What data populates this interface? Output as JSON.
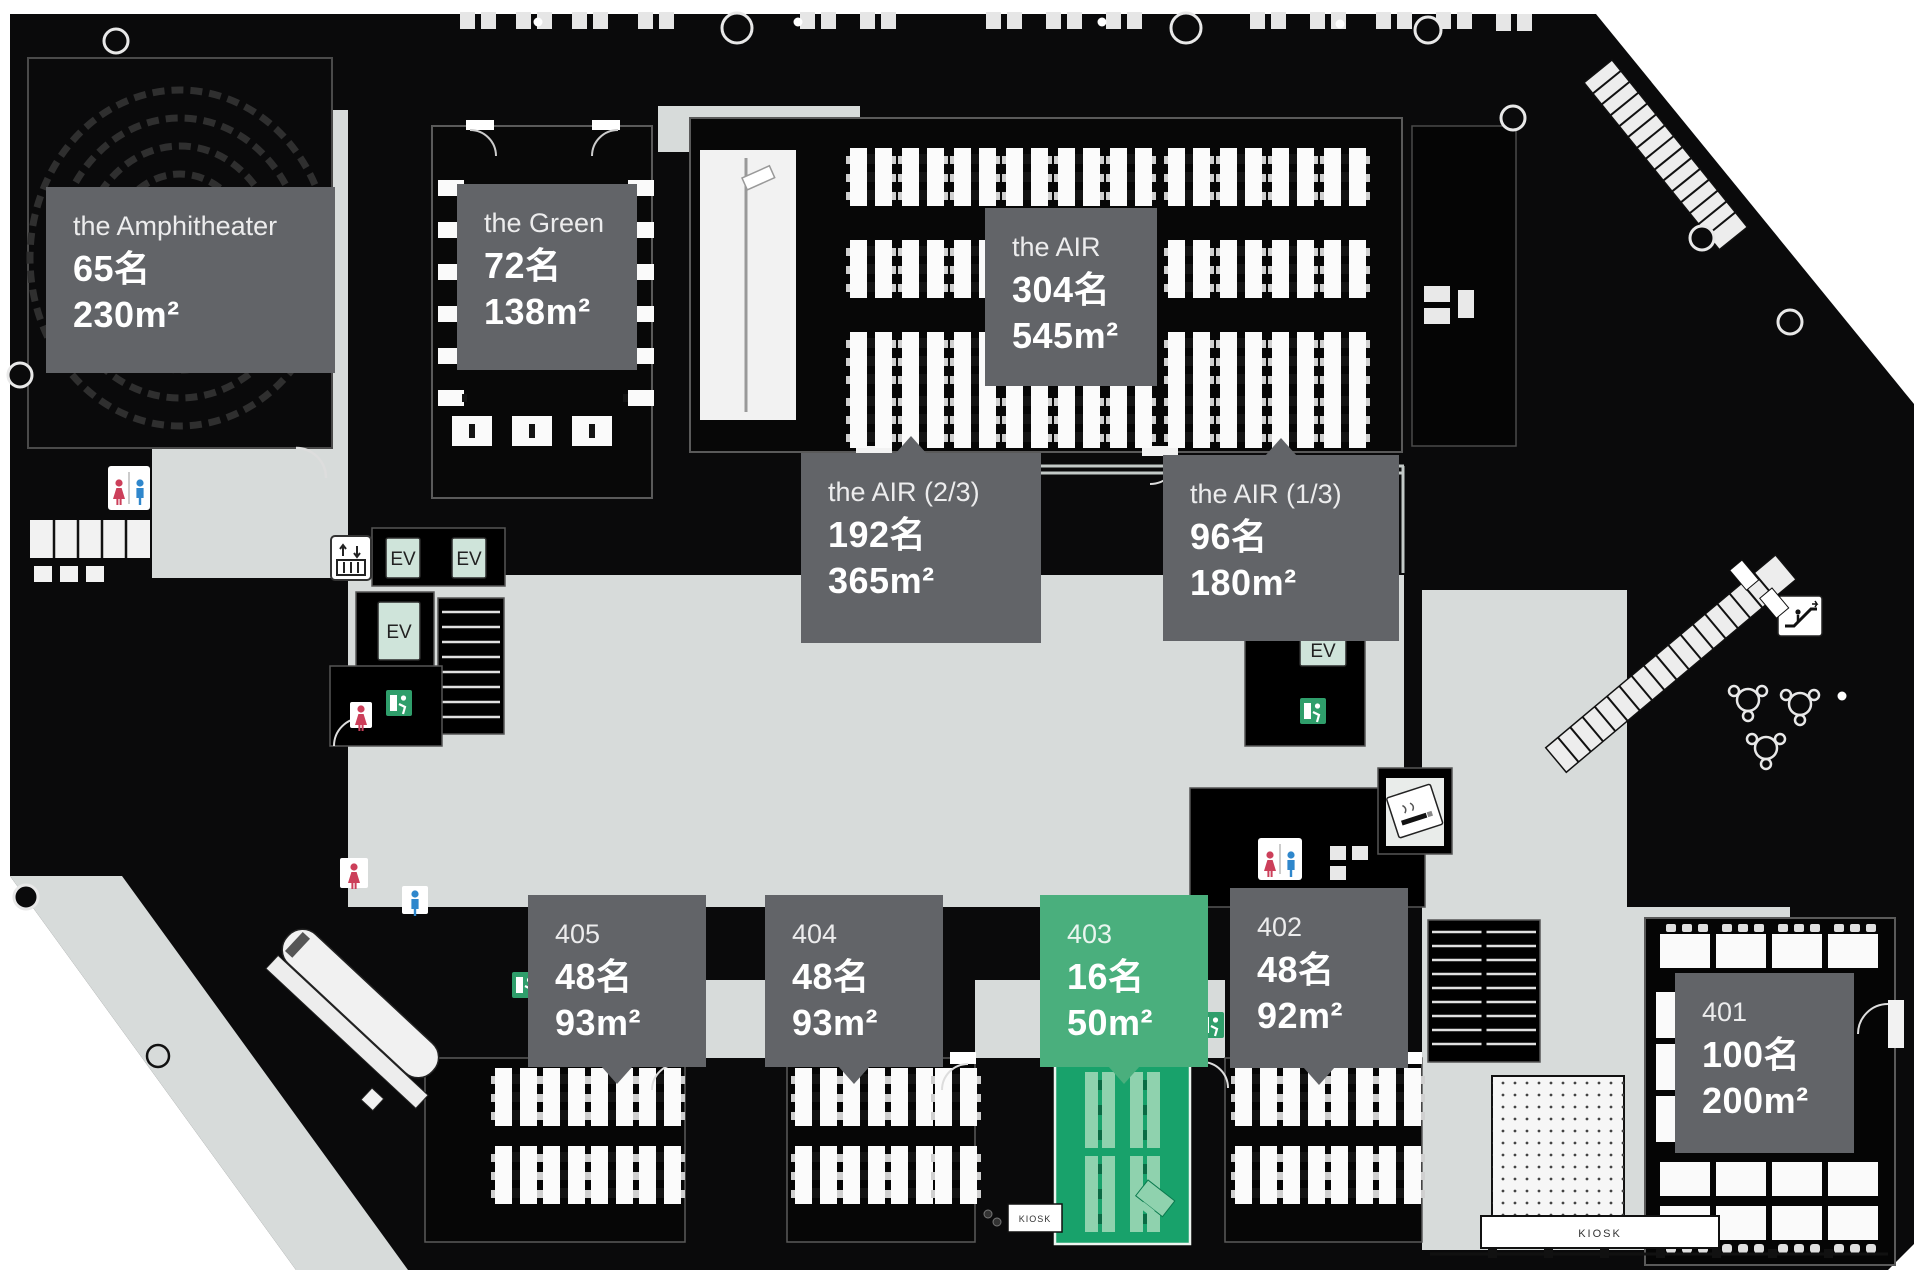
{
  "labels": [
    {
      "name": "the Amphitheater",
      "capacity": "65名",
      "area": "230m²"
    },
    {
      "name": "the Green",
      "capacity": "72名",
      "area": "138m²"
    },
    {
      "name": "the AIR",
      "capacity": "304名",
      "area": "545m²"
    },
    {
      "name": "the AIR (2/3)",
      "capacity": "192名",
      "area": "365m²"
    },
    {
      "name": "the AIR (1/3)",
      "capacity": "96名",
      "area": "180m²"
    },
    {
      "name": "405",
      "capacity": "48名",
      "area": "93m²"
    },
    {
      "name": "404",
      "capacity": "48名",
      "area": "93m²"
    },
    {
      "name": "403",
      "capacity": "16名",
      "area": "50m²",
      "highlighted": true
    },
    {
      "name": "402",
      "capacity": "48名",
      "area": "92m²"
    },
    {
      "name": "401",
      "capacity": "100名",
      "area": "200m²"
    }
  ],
  "signs": {
    "ev": "EV",
    "kiosk": "KIOSK"
  },
  "icons": {
    "elevator": "elevator-icon",
    "escalator": "escalator-icon",
    "stairs": "stairs-hatch",
    "restroom_female": "female-figure-icon",
    "restroom_male": "male-figure-icon",
    "emergency_exit": "running-man-exit-icon",
    "smoking_area": "cigarette-icon",
    "kiosk": "kiosk-counter"
  },
  "palette": {
    "building": "#0a0a0b",
    "floor_gray": "#d7dbda",
    "label_gray": "#626468",
    "label_green": "#4aaf7d",
    "room_green": "#18a26b",
    "table_green_light": "#8fd2ae",
    "ev_mint": "#cfe4da",
    "exit_green": "#2f9e6b",
    "female_red": "#cc3f5a",
    "male_blue": "#2f87cc"
  }
}
